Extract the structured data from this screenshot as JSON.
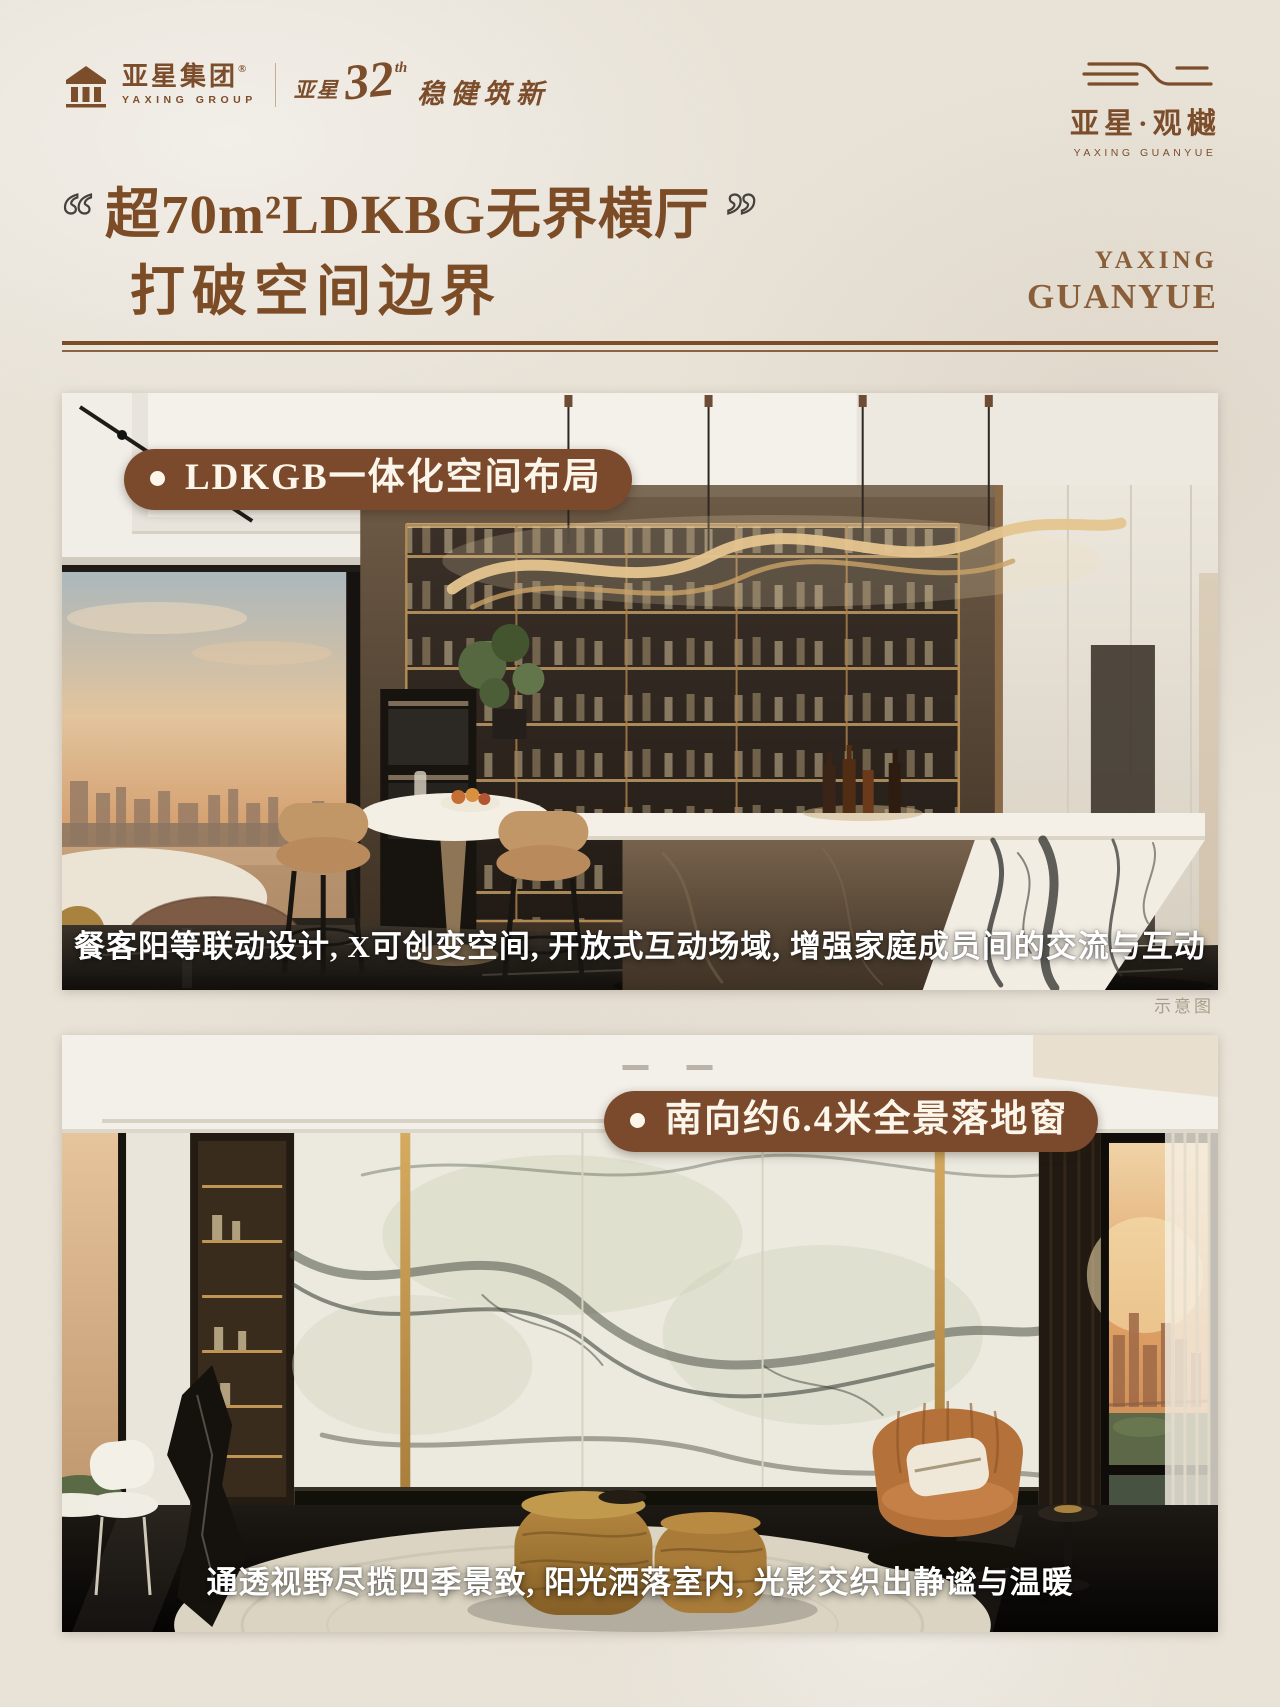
{
  "header": {
    "group_logo": {
      "cn": "亚星集团",
      "reg": "®",
      "en": "YAXING GROUP",
      "anniversary": {
        "prefix": "亚星",
        "num": "32",
        "suffix": "th",
        "slogan": "稳健筑新"
      }
    },
    "brand_logo": {
      "cn": "亚星·观樾",
      "en": "YAXING GUANYUE"
    }
  },
  "hero": {
    "quote_open": "“",
    "quote_close": "”",
    "title_line1": "超70m²LDKBG无界横厅",
    "title_line2": "打破空间边界",
    "side_en_line1": "YAXING",
    "side_en_line2": "GUANYUE"
  },
  "section1": {
    "badge": "LDKGB一体化空间布局",
    "caption": "餐客阳等联动设计, X可创变空间, 开放式互动场域, 增强家庭成员间的交流与互动",
    "watermark": "示意图"
  },
  "section2": {
    "badge": "南向约6.4米全景落地窗",
    "caption": "通透视野尽揽四季景致, 阳光洒落室内, 光影交织出静谧与温暖"
  },
  "colors": {
    "accent_brown": "#7b4c26",
    "badge_brown": "#7b4a2c",
    "paper_beige": "#e9e3d8"
  }
}
